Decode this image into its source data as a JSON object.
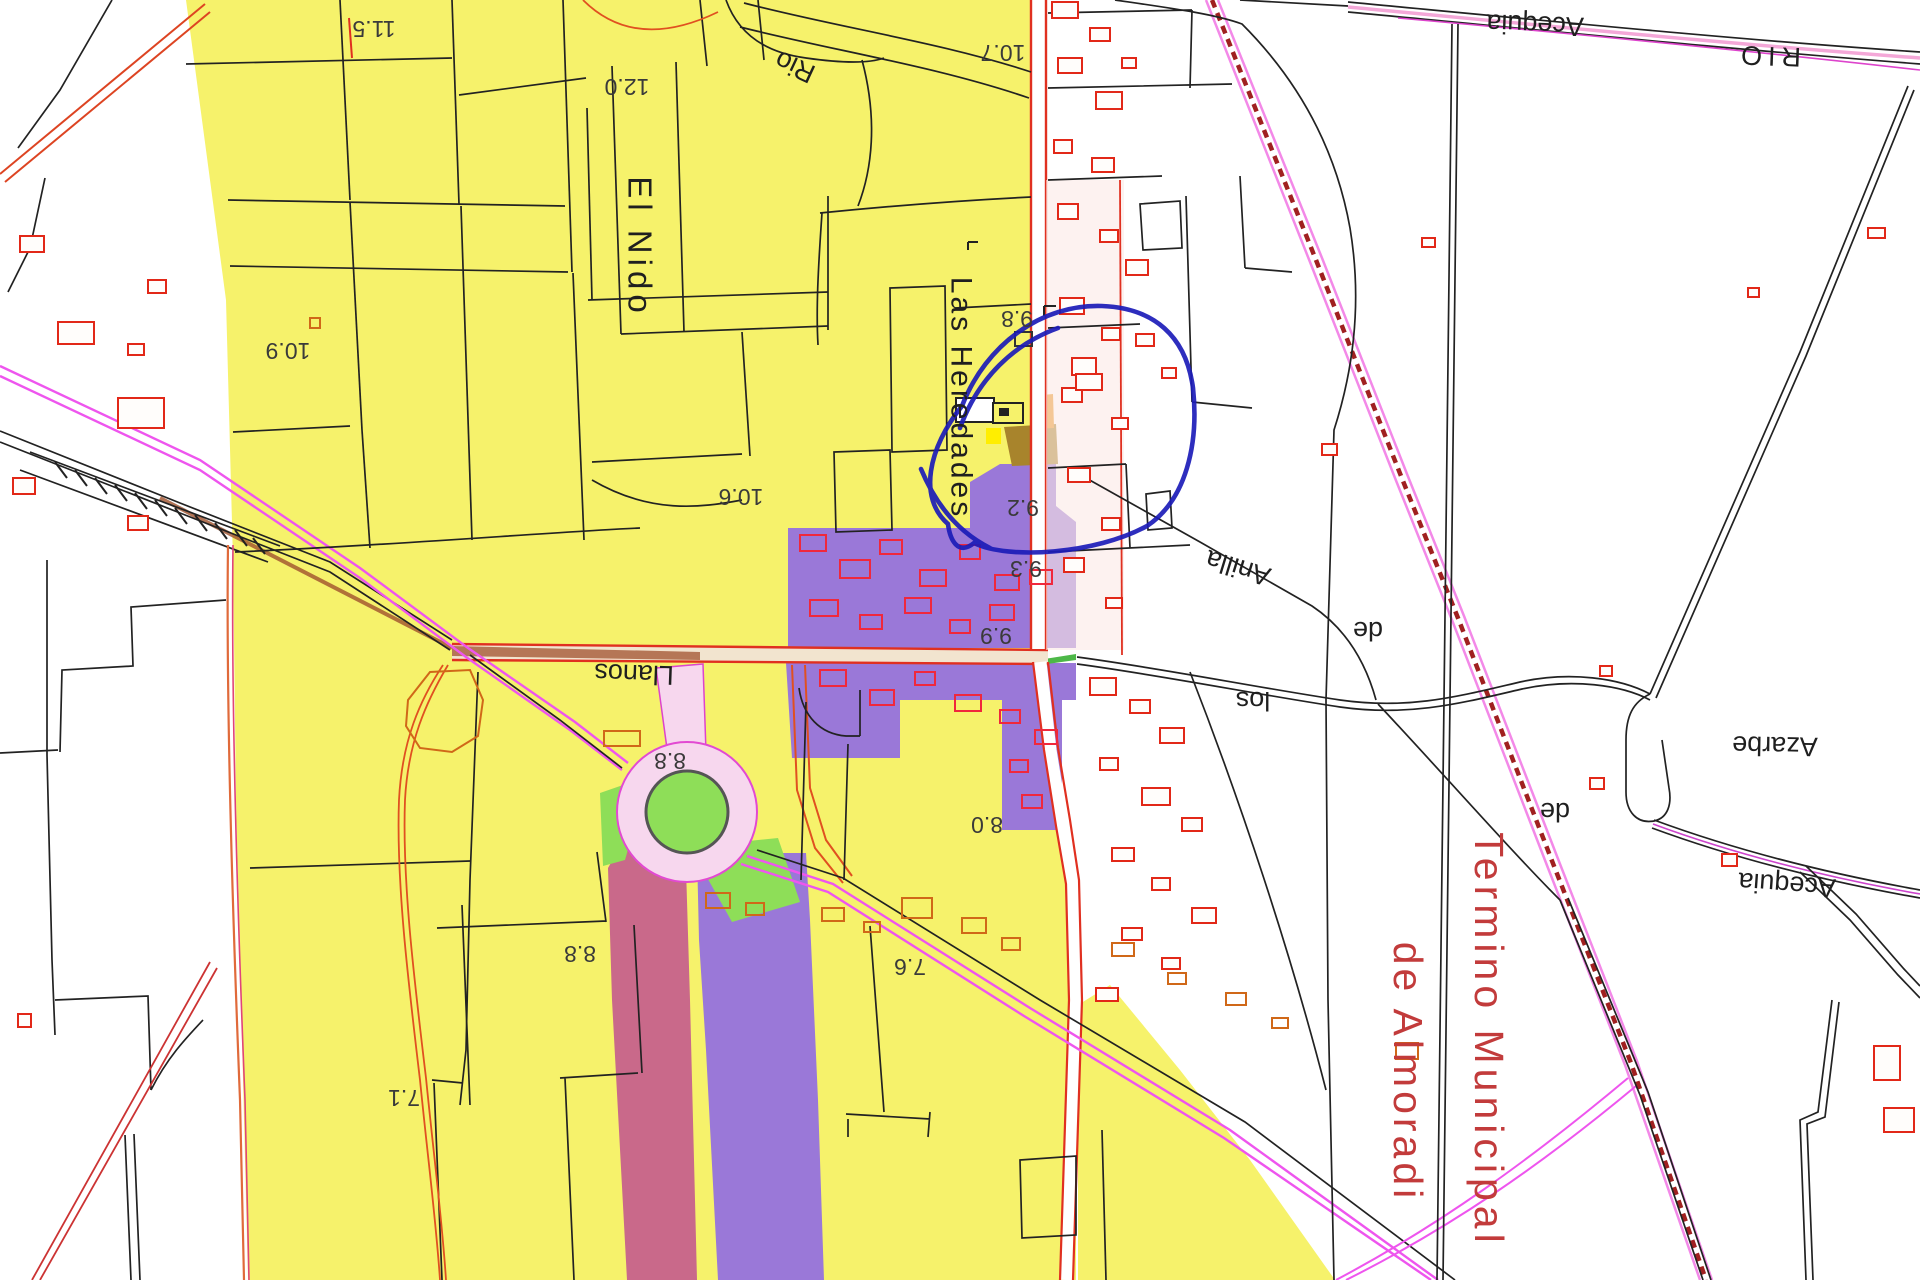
{
  "map": {
    "labels": {
      "elev_11_5": "11.5",
      "elev_12_0": "12.0",
      "elev_10_7": "10.7",
      "elev_10_9": "10.9",
      "elev_10_6": "10.6",
      "elev_9_8": "9.8",
      "elev_9_2": "9.2",
      "elev_9_3": "9.3",
      "elev_9_9": "9.9",
      "elev_8_8_a": "8.8",
      "elev_8_8_b": "8.8",
      "elev_8_0": "8.0",
      "elev_7_6": "7.6",
      "elev_7_1": "7.1",
      "rio_small": "Rio",
      "rio_big": "RIO",
      "acequia_top": "Acequia",
      "acequia_right": "Acequia",
      "azarbe": "Azarbe",
      "anilla": "Anilla",
      "de_a": "de",
      "los": "los",
      "de_b": "de",
      "el_nido": "El Nido",
      "las_heredades": "Las Heredades",
      "llanos": "Llanos",
      "termino_municipal": "Termino Municipal",
      "de_almoradi": "de Almoradi"
    },
    "colors": {
      "farmland_yellow": "#f6f26b",
      "urban_purple": "#9a78d8",
      "corridor_pink": "#c9698a",
      "green_zone": "#8ede58",
      "parcel_red": "#e22818",
      "railway_magenta": "#ee55ee",
      "boundary_dark_red": "#a02020",
      "annotation_blue": "#1c1cb8",
      "municipal_text_red": "#c23b3b"
    }
  }
}
